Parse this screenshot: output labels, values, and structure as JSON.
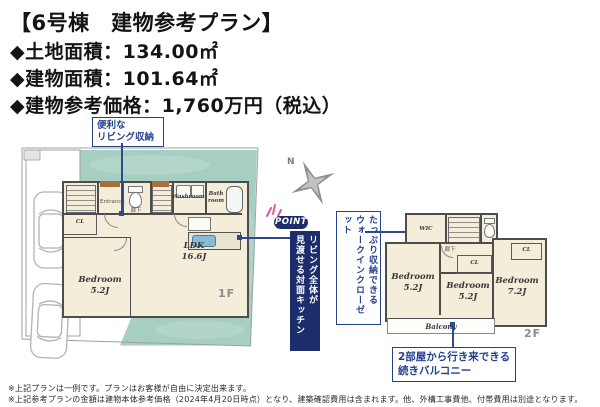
{
  "header": {
    "title": "【6号棟　建物参考プラン】",
    "land_area": "◆土地面積：134.00㎡",
    "building_area": "◆建物面積：101.64㎡",
    "price": "◆建物参考価格：1,760万円（税込）"
  },
  "callouts": {
    "living_storage": {
      "line1": "便利な",
      "line2": "リビング収納"
    },
    "point_badge": "POINT",
    "kitchen_banner": {
      "line1": "リビング全体が",
      "line2": "見渡せる対面キッチン"
    },
    "wic_note": {
      "line1": "たっぷり収納できる",
      "line2": "ウォークインクローゼット"
    },
    "balcony_note": {
      "line1": "2部屋から行き来できる",
      "line2": "続きバルコニー"
    }
  },
  "compass": {
    "north": "N"
  },
  "floor1": {
    "label": "1F",
    "rooms": {
      "bedroom_name": "Bedroom",
      "bedroom_size": "5.2J",
      "ldk_name": "LDK",
      "ldk_size": "16.6J",
      "washroom": "Washroom",
      "bath_line1": "Bath",
      "bath_line2": "room",
      "entrance": "Entrance",
      "hallway": "廊下",
      "cl": "CL"
    }
  },
  "floor2": {
    "label": "2F",
    "rooms": {
      "wic": "WIC",
      "hallway": "廊下",
      "cl_hall": "CL",
      "cl_right": "CL",
      "bedroom_left_name": "Bedroom",
      "bedroom_left_size": "5.2J",
      "bedroom_mid_name": "Bedroom",
      "bedroom_mid_size": "5.2J",
      "bedroom_right_name": "Bedroom",
      "bedroom_right_size": "7.2J",
      "balcony": "Balcony"
    }
  },
  "footnotes": [
    "※上記プランは一例です。プランはお客様が自由に決定出来ます。",
    "※上記参考プランの金額は建物本体参考価格（2024年4月20日時点）となり、建築確認費用は含まれます。他、外構工事費他、付帯費用は別途となります。"
  ],
  "colors": {
    "accent_navy": "#24418c",
    "banner_navy": "#1b2d6b",
    "site_teal": "#a6cec1",
    "room_cream": "#f3edd9",
    "wall_gray": "#4d4d4d"
  }
}
